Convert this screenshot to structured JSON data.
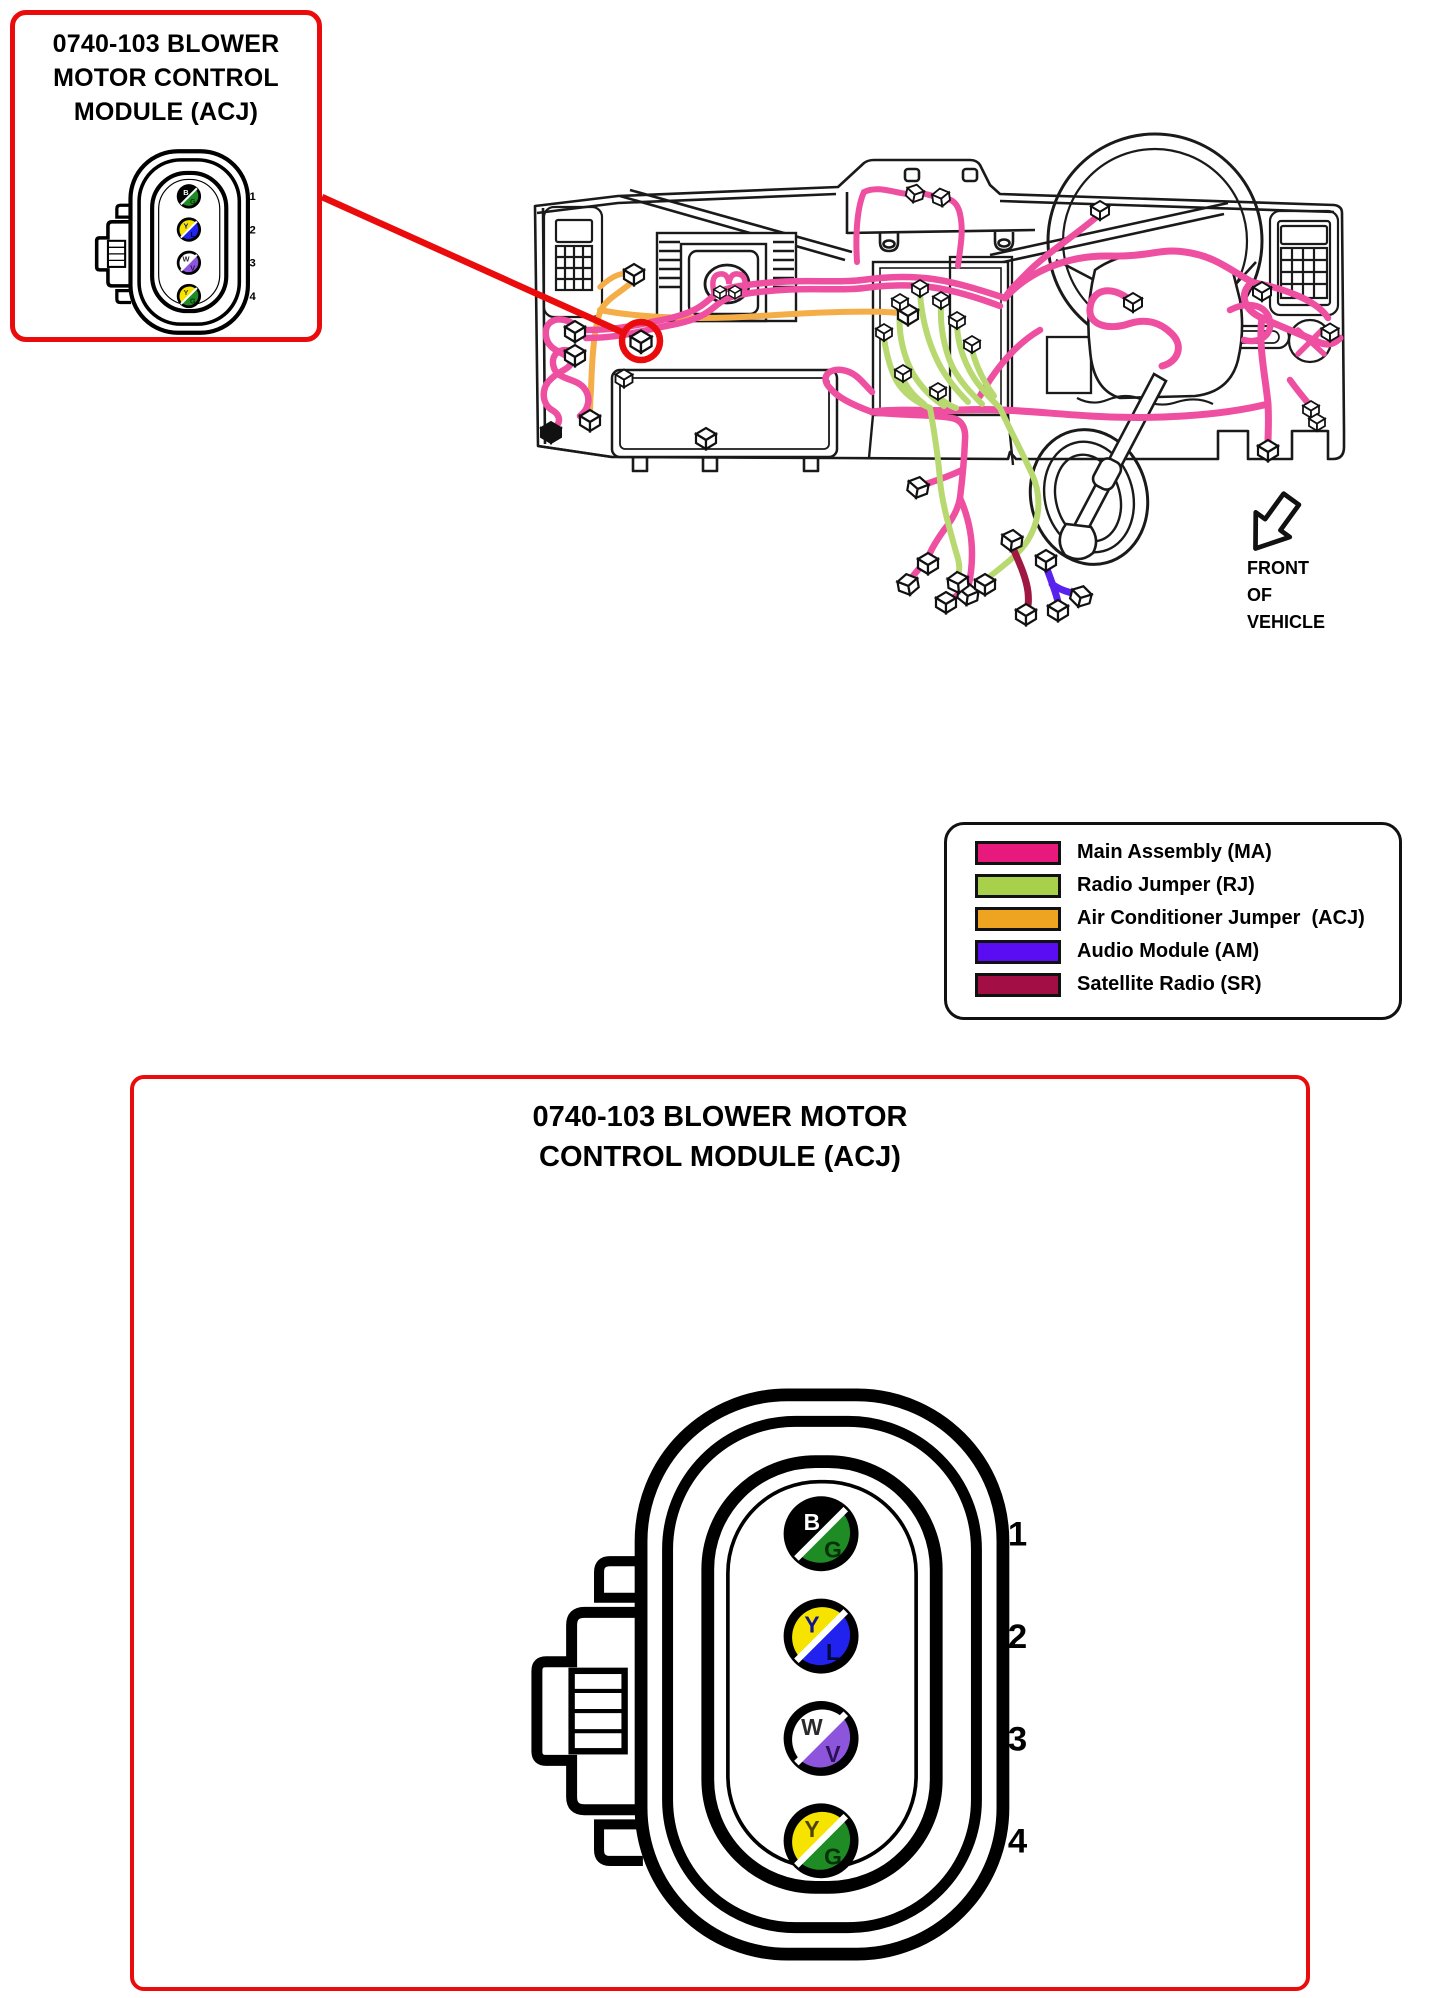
{
  "page": {
    "background": "#ffffff"
  },
  "callout": {
    "title_lines": [
      "0740-103 BLOWER",
      "MOTOR CONTROL",
      "MODULE (ACJ)"
    ]
  },
  "detail_box": {
    "title_lines": [
      "0740-103 BLOWER MOTOR",
      "CONTROL MODULE (ACJ)"
    ]
  },
  "diagram": {
    "front_of_vehicle": [
      "FRONT",
      "OF",
      "VEHICLE"
    ]
  },
  "legend": {
    "items": [
      {
        "code": "MA",
        "label": "Main Assembly (MA)",
        "color": "#e8197d"
      },
      {
        "code": "RJ",
        "label": "Radio Jumper (RJ)",
        "color": "#a8d04b"
      },
      {
        "code": "ACJ",
        "label": "Air Conditioner Jumper  (ACJ)",
        "color": "#eea321"
      },
      {
        "code": "AM",
        "label": "Audio Module (AM)",
        "color": "#5a0cf2"
      },
      {
        "code": "SR",
        "label": "Satellite Radio (SR)",
        "color": "#a30e45"
      }
    ]
  },
  "connector": {
    "pins": [
      {
        "number": "1",
        "top_letter": "B",
        "top_color": "#000000",
        "top_letter_color": "#ffffff",
        "bottom_letter": "G",
        "bottom_color": "#1f8b24",
        "bottom_letter_color": "#053008"
      },
      {
        "number": "2",
        "top_letter": "Y",
        "top_color": "#f6e400",
        "top_letter_color": "#14148c",
        "bottom_letter": "L",
        "bottom_color": "#2222ee",
        "bottom_letter_color": "#00083c"
      },
      {
        "number": "3",
        "top_letter": "W",
        "top_color": "#ffffff",
        "top_letter_color": "#2a2a2a",
        "bottom_letter": "V",
        "bottom_color": "#8c55dc",
        "bottom_letter_color": "#2c1058"
      },
      {
        "number": "4",
        "top_letter": "Y",
        "top_color": "#f6e400",
        "top_letter_color": "#4c4400",
        "bottom_letter": "G",
        "bottom_color": "#1f8b24",
        "bottom_letter_color": "#053008"
      }
    ]
  },
  "wires": {
    "main_assembly": "#ee4fa0",
    "radio_jumper": "#b7d96f",
    "ac_jumper": "#f4ad47",
    "audio_module": "#5a22ee",
    "satellite_radio": "#9e1843",
    "accent_red": "#ea0c0c"
  }
}
